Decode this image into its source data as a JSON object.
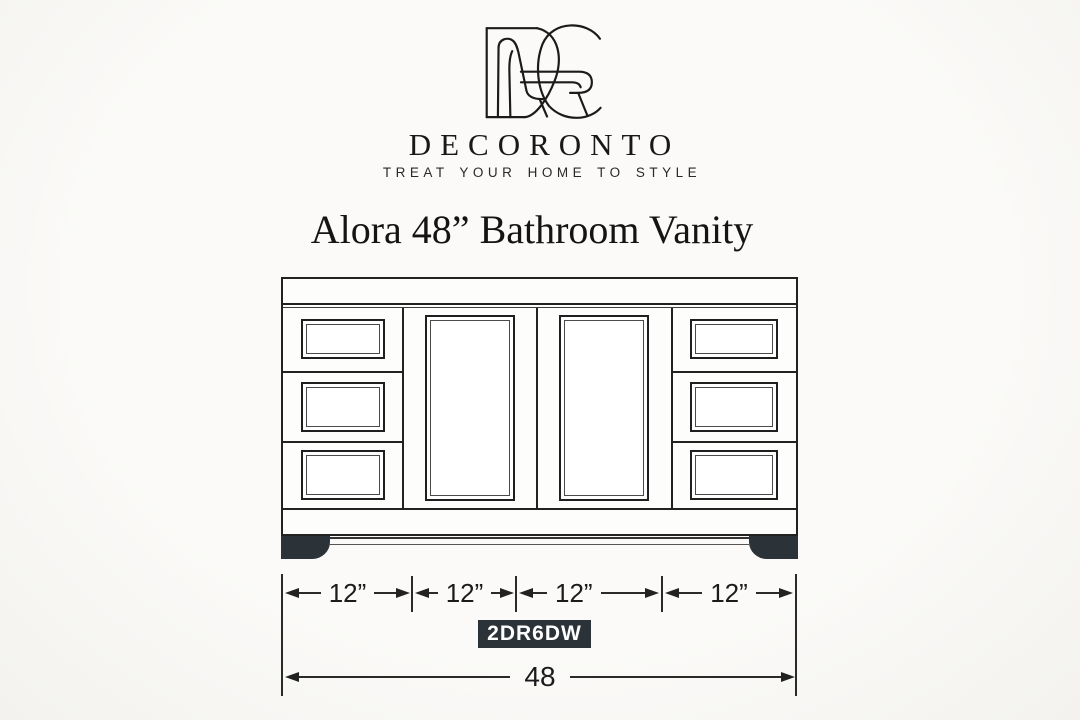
{
  "brand": {
    "name": "DECORONTO",
    "tagline": "TREAT YOUR HOME TO STYLE"
  },
  "title": "Alora 48” Bathroom Vanity",
  "accent_colors": {
    "line": "#222222",
    "dark_fill": "#2b3338",
    "background": "#f7f6f3"
  },
  "dims": {
    "segments": [
      "12”",
      "12”",
      "12”",
      "12”"
    ],
    "total": "48",
    "model": "2DR6DW"
  }
}
